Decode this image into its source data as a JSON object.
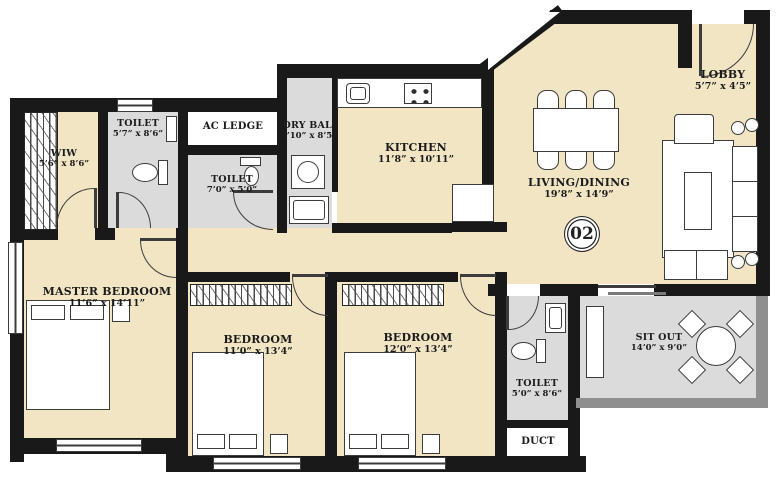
{
  "title": "Apartment Unit Floor Plan",
  "unit_number": "02",
  "colors": {
    "floor_beige": "#F1E5C4",
    "wet_area_gray": "#DBDBDB",
    "wall_black": "#191919",
    "railing_gray": "#8F8F8F"
  },
  "rooms": {
    "lobby": {
      "name": "LOBBY",
      "dims": "5’7” x 4’5”"
    },
    "living_dining": {
      "name": "LIVING/DINING",
      "dims": "19’8” x 14’9”"
    },
    "kitchen": {
      "name": "KITCHEN",
      "dims": "11’8” x 10’11”"
    },
    "dry_bal": {
      "name": "DRY BAL.",
      "dims": "3’10” x 8’5”"
    },
    "ac_ledge": {
      "name": "AC LEDGE"
    },
    "toilet_top": {
      "name": "TOILET",
      "dims": "5’7” x 8’6”"
    },
    "wiw": {
      "name": "WIW",
      "dims": "5’6” x 8’6”"
    },
    "toilet_mid": {
      "name": "TOILET",
      "dims": "7’0” x 5’0”"
    },
    "master_bedroom": {
      "name": "MASTER BEDROOM",
      "dims": "11’6” x 14’11”"
    },
    "bedroom_1": {
      "name": "BEDROOM",
      "dims": "11’0” x 13’4”"
    },
    "bedroom_2": {
      "name": "BEDROOM",
      "dims": "12’0” x 13’4”"
    },
    "toilet_bottom": {
      "name": "TOILET",
      "dims": "5’0” x 8’6”"
    },
    "duct": {
      "name": "DUCT"
    },
    "sit_out": {
      "name": "SIT OUT",
      "dims": "14’0” x 9’0”"
    }
  }
}
